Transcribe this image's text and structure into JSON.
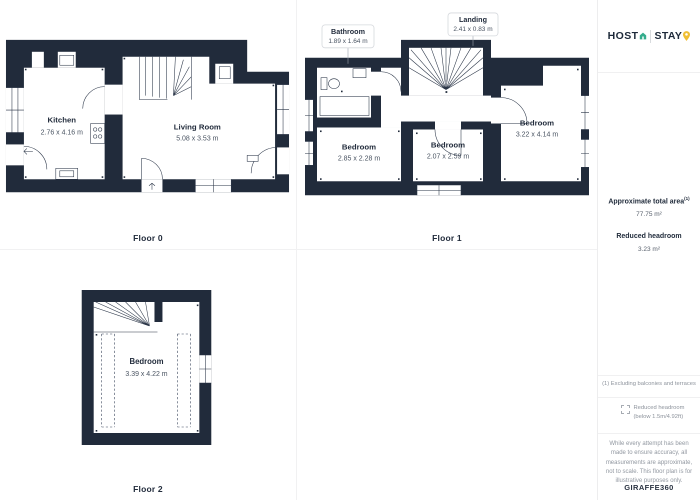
{
  "floors": [
    {
      "label": "Floor 0",
      "rooms": {
        "kitchen": {
          "name": "Kitchen",
          "dims": "2.76 x 4.16 m"
        },
        "living_room": {
          "name": "Living Room",
          "dims": "5.08 x 3.53 m"
        }
      }
    },
    {
      "label": "Floor 1",
      "rooms": {
        "bathroom": {
          "name": "Bathroom",
          "dims": "1.89 x 1.64 m"
        },
        "landing": {
          "name": "Landing",
          "dims": "2.41 x 0.83 m"
        },
        "bedroom_left": {
          "name": "Bedroom",
          "dims": "2.85 x 2.28 m"
        },
        "bedroom_middle": {
          "name": "Bedroom",
          "dims": "2.07 x 2.59 m"
        },
        "bedroom_right": {
          "name": "Bedroom",
          "dims": "3.22 x 4.14 m"
        }
      }
    },
    {
      "label": "Floor 2",
      "rooms": {
        "bedroom": {
          "name": "Bedroom",
          "dims": "3.39 x 4.22 m"
        }
      }
    }
  ],
  "sidebar": {
    "brand": {
      "host": "HOST",
      "stay": "STAY"
    },
    "total_area": {
      "label": "Approximate total area",
      "sup": "(1)",
      "value": "77.75 m²"
    },
    "reduced_headroom": {
      "label": "Reduced headroom",
      "value": "3.23 m²"
    },
    "footnote": "(1) Excluding balconies and terraces",
    "legend": "Reduced headroom (below 1.5m/4.92ft)",
    "disclaimer": "While every attempt has been made to ensure accuracy, all measurements are approximate, not to scale. This floor plan is for illustrative purposes only.",
    "credit": {
      "name": "GIRAFFE",
      "suffix": "360"
    }
  },
  "colors": {
    "wall": "#212b3b",
    "accent_green": "#34ac8c",
    "accent_yellow": "#f0bf34",
    "muted_text": "#8d939c",
    "divider": "#f0f0f1"
  }
}
